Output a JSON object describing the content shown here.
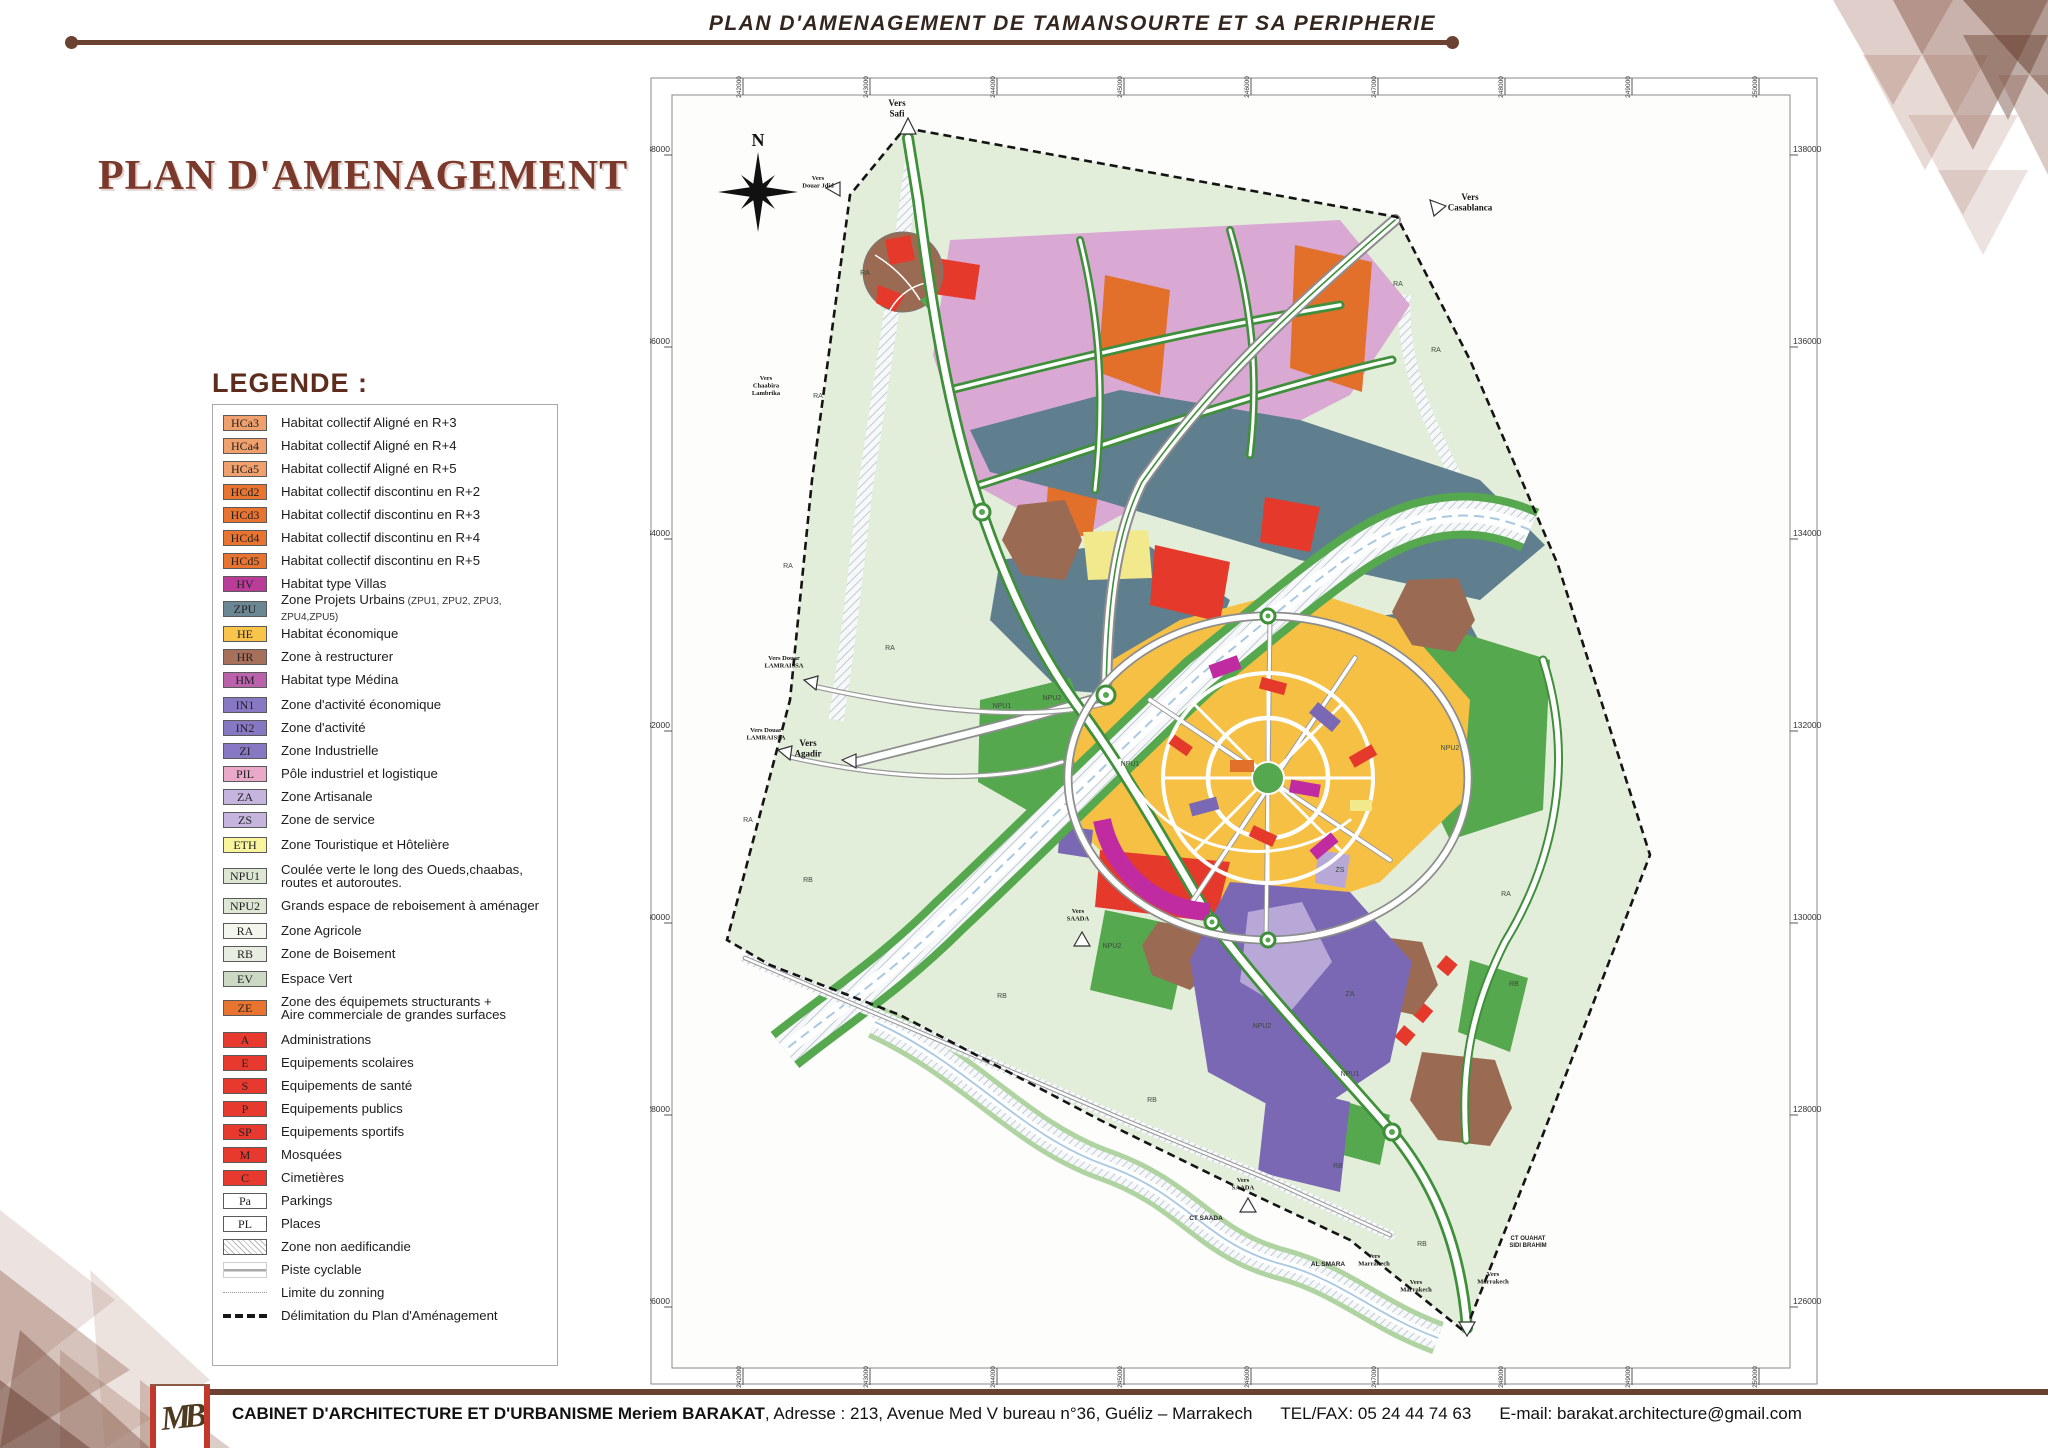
{
  "header": {
    "banner_title": "PLAN D'AMENAGEMENT DE TAMANSOURTE ET SA PERIPHERIE"
  },
  "title": "PLAN D'AMENAGEMENT",
  "legend": {
    "heading": "LEGENDE :",
    "items": [
      {
        "code": "HCa3",
        "label": "Habitat collectif Aligné en R+3",
        "swatch": "#efa06c",
        "type": "box"
      },
      {
        "code": "HCa4",
        "label": "Habitat collectif Aligné en R+4",
        "swatch": "#efa06c",
        "type": "box"
      },
      {
        "code": "HCa5",
        "label": "Habitat collectif Aligné en R+5",
        "swatch": "#efa06c",
        "type": "box"
      },
      {
        "code": "HCd2",
        "label": "Habitat collectif discontinu en R+2",
        "swatch": "#e8742f",
        "type": "box"
      },
      {
        "code": "HCd3",
        "label": "Habitat collectif discontinu en R+3",
        "swatch": "#e8742f",
        "type": "box"
      },
      {
        "code": "HCd4",
        "label": "Habitat collectif discontinu en R+4",
        "swatch": "#e8742f",
        "type": "box"
      },
      {
        "code": "HCd5",
        "label": "Habitat collectif discontinu en R+5",
        "swatch": "#e8742f",
        "type": "box"
      },
      {
        "code": "HV",
        "label": "Habitat type Villas",
        "swatch": "#ba3c99",
        "type": "box"
      },
      {
        "code": "ZPU",
        "label": "Zone Projets Urbains",
        "note": "(ZPU1, ZPU2, ZPU3, ZPU4,ZPU5)",
        "swatch": "#6c8794",
        "type": "box",
        "gap": true
      },
      {
        "code": "HE",
        "label": "Habitat économique",
        "swatch": "#f8c54a",
        "type": "box",
        "gap": true
      },
      {
        "code": "HR",
        "label": "Zone à restructurer",
        "swatch": "#a7705b",
        "type": "box"
      },
      {
        "code": "HM",
        "label": "Habitat type Médina",
        "swatch": "#ba62ac",
        "type": "box"
      },
      {
        "code": "IN1",
        "label": "Zone d'activité économique",
        "swatch": "#8878c3",
        "type": "box",
        "gap": true
      },
      {
        "code": "IN2",
        "label": "Zone d'activité",
        "swatch": "#8878c3",
        "type": "box"
      },
      {
        "code": "ZI",
        "label": "Zone Industrielle",
        "swatch": "#8878c3",
        "type": "box"
      },
      {
        "code": "PIL",
        "label": "Pôle industriel et logistique",
        "swatch": "#eaa9c8",
        "type": "box"
      },
      {
        "code": "ZA",
        "label": "Zone Artisanale",
        "swatch": "#c5b5de",
        "type": "box"
      },
      {
        "code": "ZS",
        "label": "Zone de service",
        "swatch": "#c5b5de",
        "type": "box"
      },
      {
        "code": "ETH",
        "label": "Zone Touristique et Hôtelière",
        "swatch": "#f8f59d",
        "type": "box",
        "gap": true
      },
      {
        "code": "NPU1",
        "label": "Coulée verte le long des Oueds,chaabas,\nroutes et autoroutes.",
        "swatch": "#dde7d3",
        "type": "box",
        "tall": true,
        "gap": true
      },
      {
        "code": "NPU2",
        "label": "Grands espace de reboisement à aménager",
        "swatch": "#dde7d3",
        "type": "box"
      },
      {
        "code": "RA",
        "label": "Zone Agricole",
        "swatch": "#f3f6ec",
        "type": "box",
        "gap": true
      },
      {
        "code": "RB",
        "label": "Zone de Boisement",
        "swatch": "#e7ede1",
        "type": "box"
      },
      {
        "code": "EV",
        "label": "Espace Vert",
        "swatch": "#ccd9c4",
        "type": "box",
        "gap": true
      },
      {
        "code": "ZE",
        "label": "Zone des équipemets structurants +\nAire commerciale de grandes surfaces",
        "swatch": "#e8742f",
        "type": "box",
        "tall": true
      },
      {
        "code": "A",
        "label": "Administrations",
        "swatch": "#e8392e",
        "type": "box",
        "gap": true
      },
      {
        "code": "E",
        "label": "Equipements scolaires",
        "swatch": "#e8392e",
        "type": "box"
      },
      {
        "code": "S",
        "label": "Equipements de santé",
        "swatch": "#e8392e",
        "type": "box"
      },
      {
        "code": "P",
        "label": "Equipements publics",
        "swatch": "#e8392e",
        "type": "box"
      },
      {
        "code": "SP",
        "label": "Equipements sportifs",
        "swatch": "#e8392e",
        "type": "box"
      },
      {
        "code": "M",
        "label": "Mosquées",
        "swatch": "#e8392e",
        "type": "box"
      },
      {
        "code": "C",
        "label": "Cimetières",
        "swatch": "#e8392e",
        "type": "box"
      },
      {
        "code": "Pa",
        "label": "Parkings",
        "swatch": "#ffffff",
        "type": "box"
      },
      {
        "code": "PL",
        "label": "Places",
        "swatch": "#ffffff",
        "type": "box"
      },
      {
        "code": "",
        "label": "Zone non aedificandie",
        "type": "hatch"
      },
      {
        "code": "",
        "label": "Piste cyclable",
        "type": "cycle"
      },
      {
        "code": "",
        "label": "Limite du zonning",
        "type": "dot"
      },
      {
        "code": "",
        "label": "Délimitation du Plan d'Aménagement",
        "type": "dash"
      }
    ]
  },
  "map": {
    "compass": "N",
    "frame": {
      "left_labels": [
        "138000",
        "136000",
        "134000",
        "132000",
        "130000",
        "128000",
        "126000"
      ],
      "right_labels": [
        "138000",
        "136000",
        "134000",
        "132000",
        "130000",
        "128000",
        "126000"
      ],
      "top_labels": [
        "242000",
        "243000",
        "244000",
        "245000",
        "246000",
        "247000",
        "248000",
        "249000",
        "250000"
      ],
      "bottom_labels": [
        "242000",
        "243000",
        "244000",
        "245000",
        "246000",
        "247000",
        "248000",
        "249000",
        "250000"
      ]
    },
    "direction_labels": [
      {
        "text": "Vers\nSafi",
        "x": 247,
        "y": 46,
        "fs": 9
      },
      {
        "text": "Vers\nCasablanca",
        "x": 820,
        "y": 140,
        "fs": 9
      },
      {
        "text": "Vers\nDouar Jdid",
        "x": 168,
        "y": 120,
        "fs": 6.5
      },
      {
        "text": "Vers\nAgadir",
        "x": 158,
        "y": 686,
        "fs": 9
      },
      {
        "text": "Vers\nChaabira\nLambrika",
        "x": 116,
        "y": 320,
        "fs": 6.5
      },
      {
        "text": "Vers Douar\nLAMRAISSA",
        "x": 134,
        "y": 600,
        "fs": 6.5
      },
      {
        "text": "Vers Douar\nLAMRAISSA",
        "x": 116,
        "y": 672,
        "fs": 6.5
      },
      {
        "text": "Vers\nSAADA",
        "x": 428,
        "y": 853,
        "fs": 6.5
      },
      {
        "text": "Vers\nSAADA",
        "x": 593,
        "y": 1122,
        "fs": 6.5
      },
      {
        "text": "Vers\nMarrakech",
        "x": 724,
        "y": 1198,
        "fs": 6.5
      },
      {
        "text": "Vers\nMarrakech",
        "x": 766,
        "y": 1224,
        "fs": 6.5
      },
      {
        "text": "Vers\nMarrakech",
        "x": 843,
        "y": 1216,
        "fs": 6.5
      }
    ],
    "place_labels": [
      {
        "text": "AL SMARA",
        "x": 678,
        "y": 1206,
        "fs": 6.5
      },
      {
        "text": "CT SAADA",
        "x": 556,
        "y": 1160,
        "fs": 6.5
      },
      {
        "text": "CT OUAHAT\nSIDI BRAHIM",
        "x": 878,
        "y": 1180,
        "fs": 6
      }
    ],
    "zone_labels": [
      {
        "text": "RA",
        "x": 215,
        "y": 215
      },
      {
        "text": "RA",
        "x": 168,
        "y": 338
      },
      {
        "text": "RA",
        "x": 138,
        "y": 508
      },
      {
        "text": "RA",
        "x": 240,
        "y": 590
      },
      {
        "text": "RA",
        "x": 98,
        "y": 762
      },
      {
        "text": "RA",
        "x": 748,
        "y": 226
      },
      {
        "text": "RA",
        "x": 786,
        "y": 292
      },
      {
        "text": "RA",
        "x": 856,
        "y": 836
      },
      {
        "text": "RB",
        "x": 158,
        "y": 822
      },
      {
        "text": "RB",
        "x": 352,
        "y": 938
      },
      {
        "text": "RB",
        "x": 502,
        "y": 1042
      },
      {
        "text": "RB",
        "x": 688,
        "y": 1108
      },
      {
        "text": "RB",
        "x": 772,
        "y": 1186
      },
      {
        "text": "RB",
        "x": 864,
        "y": 926
      },
      {
        "text": "NPU1",
        "x": 352,
        "y": 648
      },
      {
        "text": "NPU1",
        "x": 480,
        "y": 706
      },
      {
        "text": "NPU1",
        "x": 700,
        "y": 1016
      },
      {
        "text": "NPU2",
        "x": 800,
        "y": 690
      },
      {
        "text": "NPU2",
        "x": 462,
        "y": 888
      },
      {
        "text": "NPU2",
        "x": 612,
        "y": 968
      },
      {
        "text": "NPU2",
        "x": 402,
        "y": 640
      },
      {
        "text": "ZS",
        "x": 690,
        "y": 812
      },
      {
        "text": "ZA",
        "x": 700,
        "y": 936
      }
    ],
    "palette": {
      "agricole_bg": "#e3eeda",
      "villas": "#d9a9d4",
      "zpu": "#5f7f8e",
      "habitat_eco": "#f5c044",
      "orange_ze": "#e2702a",
      "rouge_equip": "#e53a2b",
      "medina": "#c02ba2",
      "restructurer": "#9b6a52",
      "industrie": "#7a68b4",
      "service": "#b7a8d8",
      "coulee_verte": "#56a84e",
      "eth": "#f2e98c"
    }
  },
  "footer": {
    "logo": "MB",
    "cabinet": "CABINET D'ARCHITECTURE  ET D'URBANISME Meriem BARAKAT",
    "address": ",  Adresse : 213, Avenue Med V bureau n°36, Guéliz – Marrakech",
    "telfax": "TEL/FAX: 05 24 44 74 63",
    "email": "E-mail: barakat.architecture@gmail.com"
  }
}
